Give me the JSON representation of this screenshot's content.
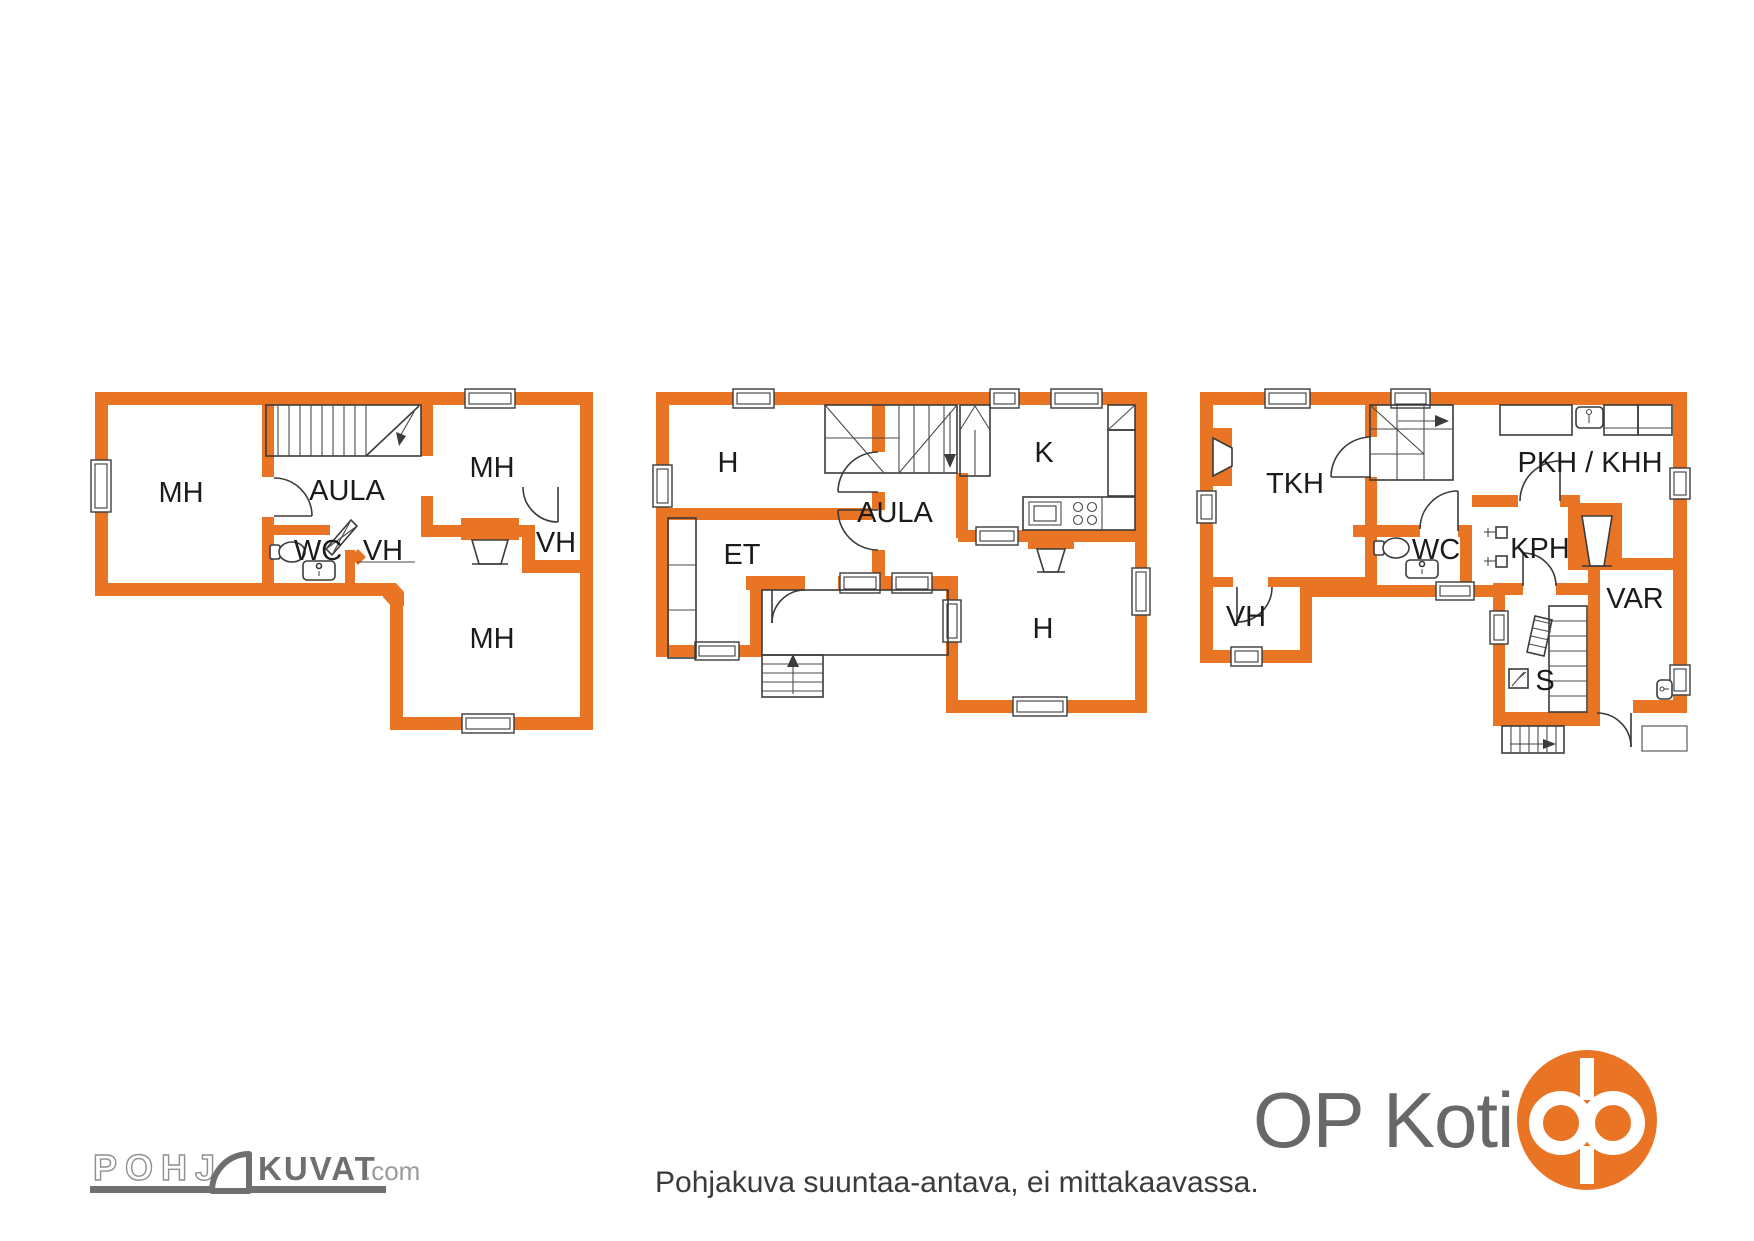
{
  "colors": {
    "wall": "#e87424",
    "line": "#3b3b3b",
    "label_text": "#1b1b1b",
    "op_orange": "#e87424",
    "brand_gray": "#686868",
    "watermark_gray": "#6f6f6f"
  },
  "plans": [
    {
      "id": "floor-plan-left",
      "rooms": [
        {
          "label": "MH"
        },
        {
          "label": "AULA"
        },
        {
          "label": "MH"
        },
        {
          "label": "WC"
        },
        {
          "label": "VH"
        },
        {
          "label": "VH"
        },
        {
          "label": "MH"
        }
      ]
    },
    {
      "id": "floor-plan-middle",
      "rooms": [
        {
          "label": "H"
        },
        {
          "label": "ET"
        },
        {
          "label": "AULA"
        },
        {
          "label": "K"
        },
        {
          "label": "H"
        }
      ]
    },
    {
      "id": "floor-plan-right",
      "rooms": [
        {
          "label": "TKH"
        },
        {
          "label": "VH"
        },
        {
          "label": "WC"
        },
        {
          "label": "PKH / KHH"
        },
        {
          "label": "KPH"
        },
        {
          "label": "VAR"
        },
        {
          "label": "S"
        }
      ]
    }
  ],
  "footer": {
    "disclaimer": "Pohjakuva suuntaa-antava, ei mittakaavassa."
  },
  "branding": {
    "op_koti": "OP Koti",
    "watermark_prefix": "POHJ",
    "watermark_main": "KUVAT",
    "watermark_tld": ".com"
  }
}
